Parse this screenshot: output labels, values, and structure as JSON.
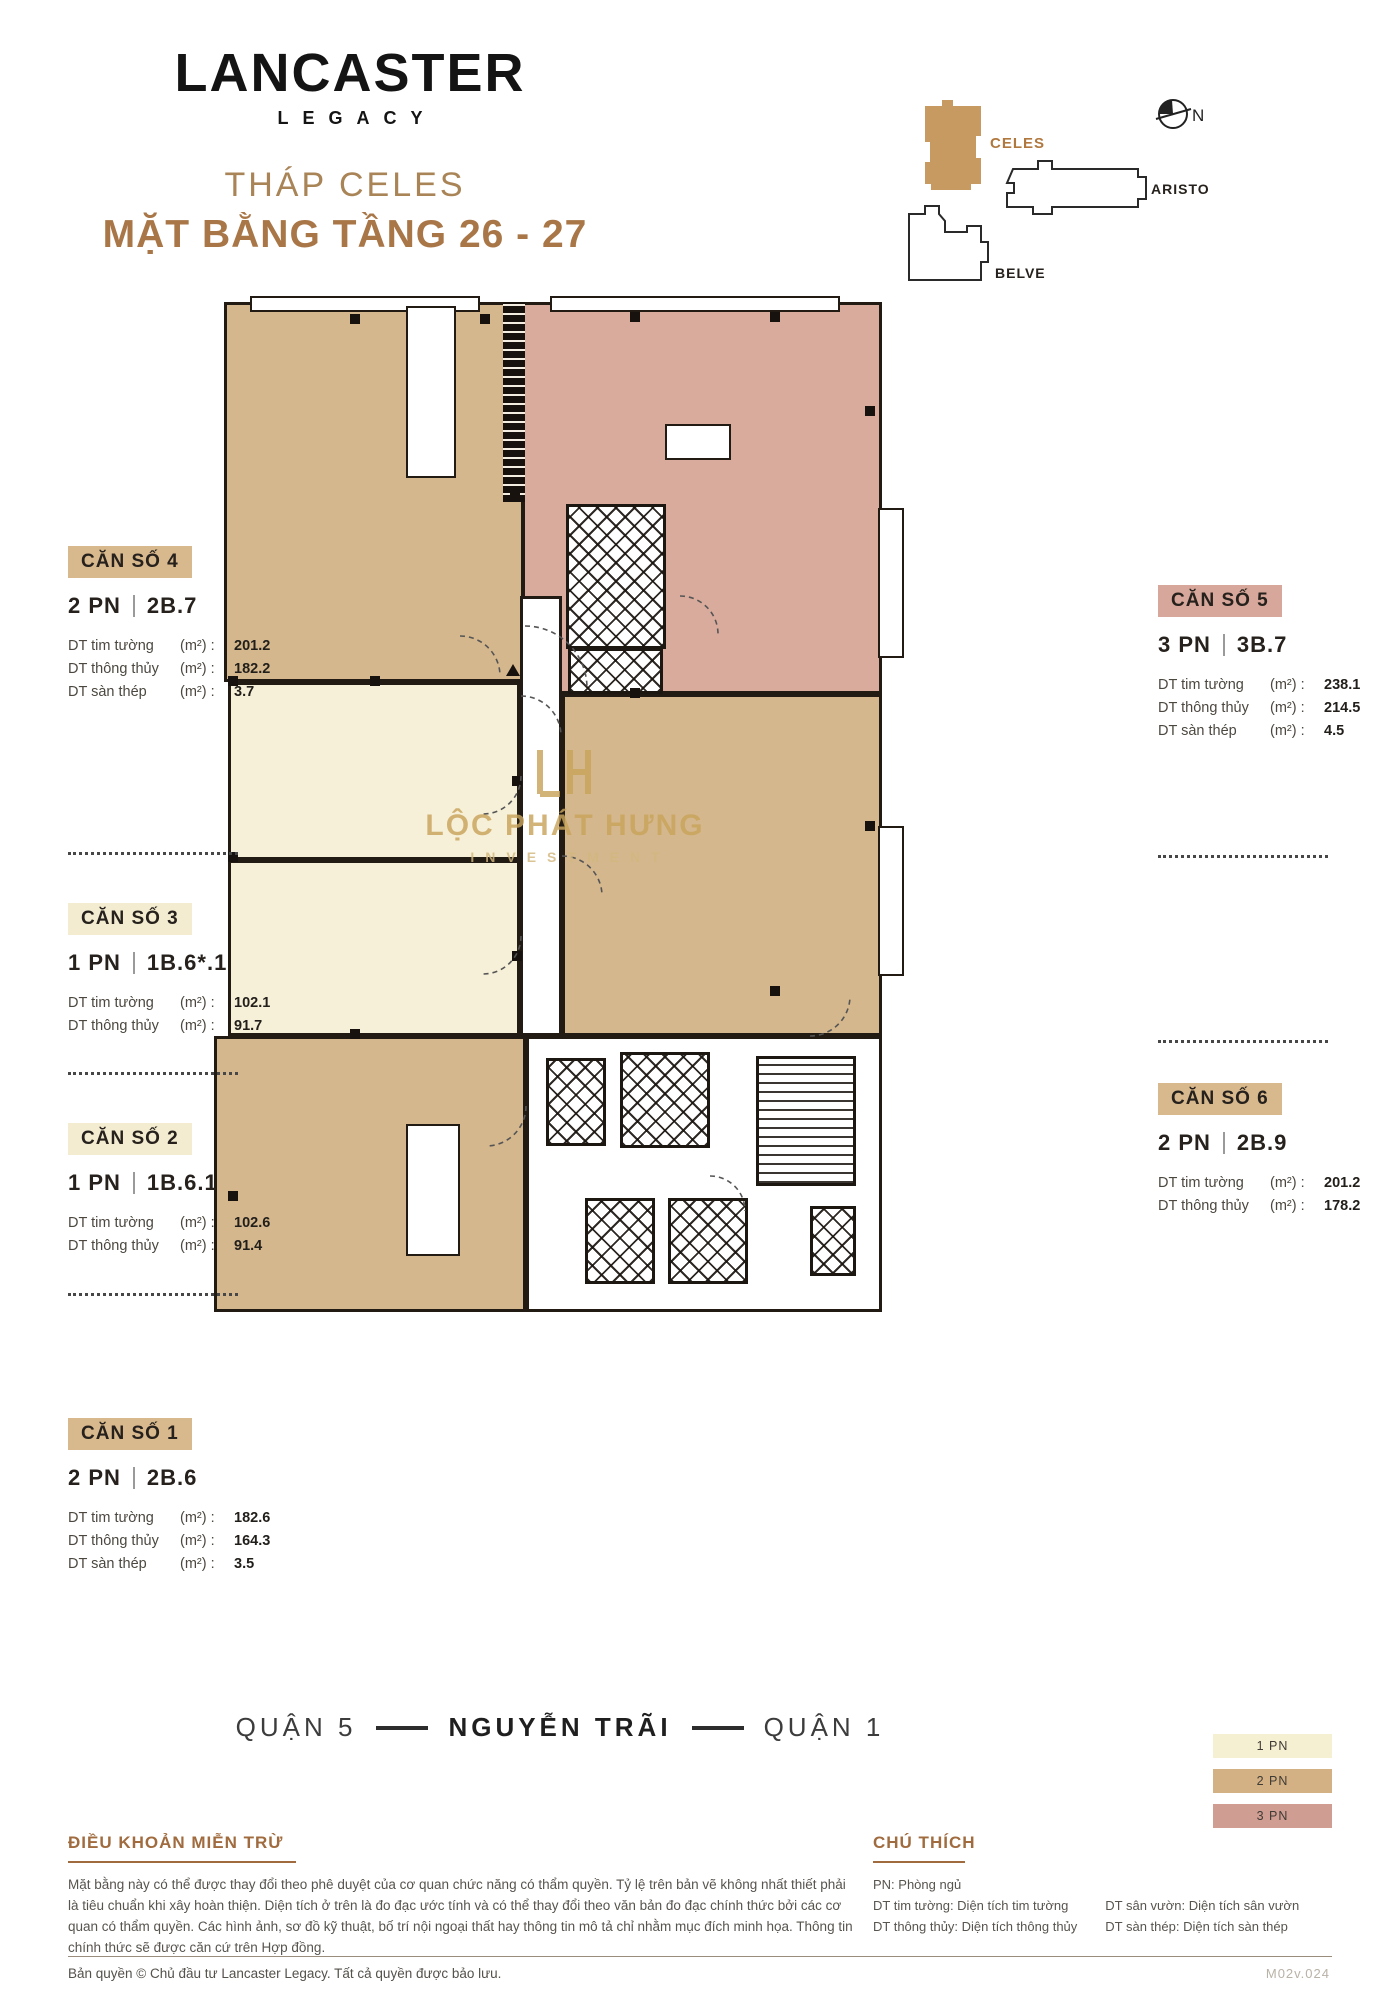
{
  "brand": {
    "name": "LANCASTER",
    "sub": "LEGACY"
  },
  "header": {
    "tower": "THÁP CELES",
    "title": "MẶT BẰNG TẦNG 26 - 27"
  },
  "minimap": {
    "celes_label": "CELES",
    "aristo_label": "ARISTO",
    "belve_label": "BELVE",
    "north_label": "N"
  },
  "units": [
    {
      "label": "CĂN SỐ 4",
      "type": "2 PN",
      "code": "2B.7",
      "metrics": [
        {
          "name": "DT tim tường",
          "unit": "(m²) :",
          "value": "201.2"
        },
        {
          "name": "DT thông thủy",
          "unit": "(m²) :",
          "value": "182.2"
        },
        {
          "name": "DT sàn thép",
          "unit": "(m²) :",
          "value": "3.7"
        }
      ]
    },
    {
      "label": "CĂN SỐ 3",
      "type": "1 PN",
      "code": "1B.6*.1",
      "metrics": [
        {
          "name": "DT tim tường",
          "unit": "(m²) :",
          "value": "102.1"
        },
        {
          "name": "DT thông thủy",
          "unit": "(m²) :",
          "value": "91.7"
        }
      ]
    },
    {
      "label": "CĂN SỐ 2",
      "type": "1 PN",
      "code": "1B.6.1",
      "metrics": [
        {
          "name": "DT tim tường",
          "unit": "(m²) :",
          "value": "102.6"
        },
        {
          "name": "DT thông thủy",
          "unit": "(m²) :",
          "value": "91.4"
        }
      ]
    },
    {
      "label": "CĂN SỐ 1",
      "type": "2 PN",
      "code": "2B.6",
      "metrics": [
        {
          "name": "DT tim tường",
          "unit": "(m²) :",
          "value": "182.6"
        },
        {
          "name": "DT thông thủy",
          "unit": "(m²) :",
          "value": "164.3"
        },
        {
          "name": "DT sàn thép",
          "unit": "(m²) :",
          "value": "3.5"
        }
      ]
    },
    {
      "label": "CĂN SỐ 5",
      "type": "3 PN",
      "code": "3B.7",
      "metrics": [
        {
          "name": "DT tim tường",
          "unit": "(m²) :",
          "value": "238.1"
        },
        {
          "name": "DT thông thủy",
          "unit": "(m²) :",
          "value": "214.5"
        },
        {
          "name": "DT sàn thép",
          "unit": "(m²) :",
          "value": "4.5"
        }
      ]
    },
    {
      "label": "CĂN SỐ 6",
      "type": "2 PN",
      "code": "2B.9",
      "metrics": [
        {
          "name": "DT tim tường",
          "unit": "(m²) :",
          "value": "201.2"
        },
        {
          "name": "DT thông thủy",
          "unit": "(m²) :",
          "value": "178.2"
        }
      ]
    }
  ],
  "street": {
    "left": "QUẬN 5",
    "center": "NGUYỄN TRÃI",
    "right": "QUẬN 1"
  },
  "legend": [
    {
      "label": "1 PN",
      "color": "#f6f0d3"
    },
    {
      "label": "2 PN",
      "color": "#d3b184"
    },
    {
      "label": "3 PN",
      "color": "#d09d92"
    }
  ],
  "watermark": {
    "line1": "LỘC PHÁT HƯNG",
    "line2": "INVESTMENT"
  },
  "disclaimer": {
    "heading": "ĐIỀU KHOẢN MIỄN TRỪ",
    "body": "Mặt bằng này có thể được thay đổi theo phê duyệt của cơ quan chức năng có thẩm quyền. Tỷ lệ trên bản vẽ không nhất thiết phải là tiêu chuẩn khi xây hoàn thiện. Diện tích ở trên là đo đạc ước tính và có thể thay đổi theo văn bản đo đạc chính thức bởi các cơ quan có thẩm quyền. Các hình ảnh, sơ đồ kỹ thuật, bố trí nội ngoại thất hay thông tin mô tả chỉ nhằm mục đích minh họa. Thông tin chính thức sẽ được căn cứ trên Hợp đồng."
  },
  "notes": {
    "heading": "CHÚ THÍCH",
    "col1": [
      "PN: Phòng ngủ",
      "DT tim tường: Diện tích tim tường",
      "DT thông thủy: Diện tích thông thủy"
    ],
    "col2": [
      "DT sân vườn: Diện tích sân vườn",
      "DT sàn thép: Diện tích sàn thép"
    ]
  },
  "footer": {
    "copyright": "Bản quyền © Chủ đầu tư Lancaster Legacy. Tất cả quyền được bảo lưu.",
    "version": "M02v.024"
  },
  "plan_colors": {
    "wall": "#221b14",
    "1pn": "#f7f0d8",
    "2pn": "#d5b78d",
    "3pn": "#d9ab9d"
  }
}
